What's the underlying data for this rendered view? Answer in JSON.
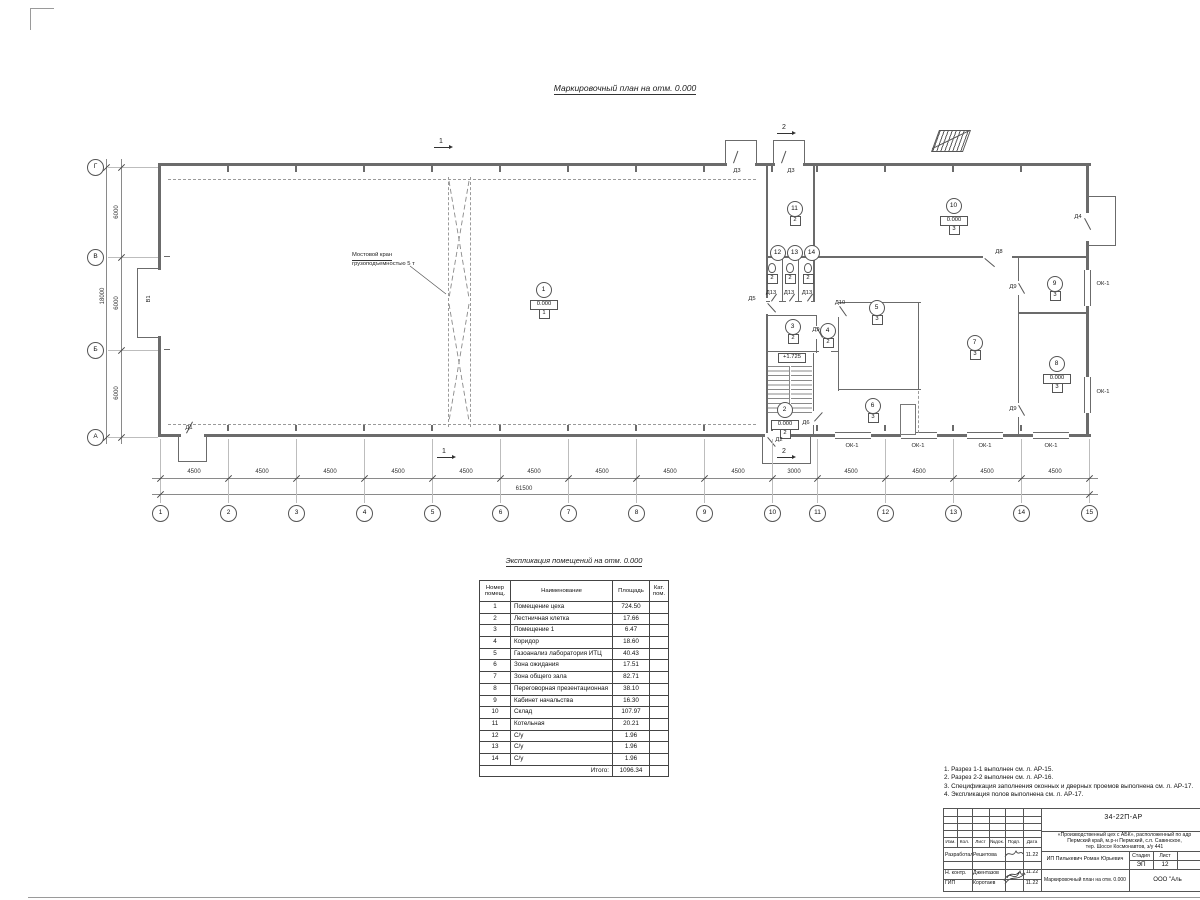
{
  "titles": {
    "plan": "Маркировочный план  на отм. 0.000",
    "table": "Экспликация помещений на отм. 0.000"
  },
  "plan": {
    "crane_line1": "Мостовой кран",
    "crane_line2": "грузоподъемностью 5 т",
    "gate_label": "В1",
    "stair_level": "+1.725",
    "axes_bottom": [
      {
        "n": "1",
        "x": 160
      },
      {
        "n": "2",
        "x": 228
      },
      {
        "n": "3",
        "x": 296
      },
      {
        "n": "4",
        "x": 364
      },
      {
        "n": "5",
        "x": 432
      },
      {
        "n": "6",
        "x": 500
      },
      {
        "n": "7",
        "x": 568
      },
      {
        "n": "8",
        "x": 636
      },
      {
        "n": "9",
        "x": 704
      },
      {
        "n": "10",
        "x": 772
      },
      {
        "n": "11",
        "x": 817
      },
      {
        "n": "12",
        "x": 885
      },
      {
        "n": "13",
        "x": 953
      },
      {
        "n": "14",
        "x": 1021
      },
      {
        "n": "15",
        "x": 1089
      }
    ],
    "axes_left": [
      {
        "n": "Г",
        "y": 167
      },
      {
        "n": "В",
        "y": 257
      },
      {
        "n": "Б",
        "y": 350
      },
      {
        "n": "А",
        "y": 437
      }
    ],
    "dims_bottom": [
      {
        "v": "4500",
        "x": 194
      },
      {
        "v": "4500",
        "x": 262
      },
      {
        "v": "4500",
        "x": 330
      },
      {
        "v": "4500",
        "x": 398
      },
      {
        "v": "4500",
        "x": 466
      },
      {
        "v": "4500",
        "x": 534
      },
      {
        "v": "4500",
        "x": 602
      },
      {
        "v": "4500",
        "x": 670
      },
      {
        "v": "4500",
        "x": 738
      },
      {
        "v": "3000",
        "x": 794
      },
      {
        "v": "4500",
        "x": 851
      },
      {
        "v": "4500",
        "x": 919
      },
      {
        "v": "4500",
        "x": 987
      },
      {
        "v": "4500",
        "x": 1055
      }
    ],
    "dims_left": [
      {
        "v": "6000",
        "y": 212
      },
      {
        "v": "6000",
        "y": 303
      },
      {
        "v": "6000",
        "y": 393
      }
    ],
    "total_bottom": "61500",
    "total_left": "18000",
    "rooms": [
      {
        "n": "1",
        "x": 543,
        "y": 289,
        "level": "0.000",
        "cat": "1"
      },
      {
        "n": "2",
        "x": 784,
        "y": 409,
        "level": "0.000",
        "cat": "2"
      },
      {
        "n": "3",
        "x": 792,
        "y": 326,
        "cat": "2"
      },
      {
        "n": "4",
        "x": 827,
        "y": 330,
        "cat": "2"
      },
      {
        "n": "5",
        "x": 876,
        "y": 307,
        "cat": "3"
      },
      {
        "n": "6",
        "x": 872,
        "y": 405,
        "cat": "3"
      },
      {
        "n": "7",
        "x": 974,
        "y": 342,
        "cat": "3"
      },
      {
        "n": "8",
        "x": 1056,
        "y": 363,
        "level": "0.000",
        "cat": "3"
      },
      {
        "n": "9",
        "x": 1054,
        "y": 283,
        "cat": "3"
      },
      {
        "n": "10",
        "x": 953,
        "y": 205,
        "level": "0.000",
        "cat": "3"
      },
      {
        "n": "11",
        "x": 794,
        "y": 208,
        "cat": "2"
      },
      {
        "n": "12",
        "x": 777,
        "y": 252
      },
      {
        "n": "13",
        "x": 794,
        "y": 252
      },
      {
        "n": "14",
        "x": 811,
        "y": 252
      }
    ],
    "wc_cats": [
      {
        "v": "2",
        "x": 771
      },
      {
        "v": "2",
        "x": 789
      },
      {
        "v": "2",
        "x": 807
      }
    ],
    "labels": [
      {
        "t": "В1",
        "x": 150,
        "y": 299,
        "rot": -90
      },
      {
        "t": "Д1",
        "x": 189,
        "y": 429
      },
      {
        "t": "Д2",
        "x": 779,
        "y": 441
      },
      {
        "t": "Д3",
        "x": 737,
        "y": 172
      },
      {
        "t": "Д3",
        "x": 791,
        "y": 172
      },
      {
        "t": "Д4",
        "x": 1078,
        "y": 218
      },
      {
        "t": "Д5",
        "x": 752,
        "y": 300
      },
      {
        "t": "Д6",
        "x": 806,
        "y": 424
      },
      {
        "t": "Д8",
        "x": 999,
        "y": 253
      },
      {
        "t": "Д9",
        "x": 816,
        "y": 331
      },
      {
        "t": "Д9",
        "x": 1013,
        "y": 288
      },
      {
        "t": "Д9",
        "x": 1013,
        "y": 410
      },
      {
        "t": "Д10",
        "x": 840,
        "y": 304
      },
      {
        "t": "Д13",
        "x": 771,
        "y": 294
      },
      {
        "t": "Д13",
        "x": 789,
        "y": 294
      },
      {
        "t": "Д13",
        "x": 807,
        "y": 294
      },
      {
        "t": "ОК-1",
        "x": 852,
        "y": 447
      },
      {
        "t": "ОК-1",
        "x": 918,
        "y": 447
      },
      {
        "t": "ОК-1",
        "x": 985,
        "y": 447
      },
      {
        "t": "ОК-1",
        "x": 1051,
        "y": 447
      },
      {
        "t": "ОК-1",
        "x": 1103,
        "y": 285
      },
      {
        "t": "ОК-1",
        "x": 1103,
        "y": 393
      }
    ],
    "sections": [
      {
        "t": "1",
        "x": 441,
        "y": 146
      },
      {
        "t": "1",
        "x": 444,
        "y": 456
      },
      {
        "t": "2",
        "x": 784,
        "y": 132
      },
      {
        "t": "2",
        "x": 784,
        "y": 456
      }
    ]
  },
  "table": {
    "headers": [
      "Номер помещ.",
      "Наименование",
      "Площадь",
      "Кат. пом."
    ],
    "rows": [
      {
        "n": "1",
        "name": "Помещение цеха",
        "area": "724.50",
        "cat": ""
      },
      {
        "n": "2",
        "name": "Лестничная клетка",
        "area": "17.66",
        "cat": ""
      },
      {
        "n": "3",
        "name": "Помещение 1",
        "area": "6.47",
        "cat": ""
      },
      {
        "n": "4",
        "name": "Коридор",
        "area": "18.60",
        "cat": ""
      },
      {
        "n": "5",
        "name": "Газоанализ лаборатория ИТЦ",
        "area": "40.43",
        "cat": ""
      },
      {
        "n": "6",
        "name": "Зона ожидания",
        "area": "17.51",
        "cat": ""
      },
      {
        "n": "7",
        "name": "Зона общего зала",
        "area": "82.71",
        "cat": ""
      },
      {
        "n": "8",
        "name": "Переговорная презентационная",
        "area": "38.10",
        "cat": ""
      },
      {
        "n": "9",
        "name": "Кабинет начальства",
        "area": "16.30",
        "cat": ""
      },
      {
        "n": "10",
        "name": "Склад",
        "area": "107.97",
        "cat": ""
      },
      {
        "n": "11",
        "name": "Котельная",
        "area": "20.21",
        "cat": ""
      },
      {
        "n": "12",
        "name": "С/у",
        "area": "1.96",
        "cat": ""
      },
      {
        "n": "13",
        "name": "С/у",
        "area": "1.96",
        "cat": ""
      },
      {
        "n": "14",
        "name": "С/у",
        "area": "1.96",
        "cat": ""
      }
    ],
    "total_label": "Итого:",
    "total": "1096.34"
  },
  "notes": [
    "1. Разрез 1-1 выполнен см. л. АР-15.",
    "2. Разрез 2-2 выполнен см. л. АР-16.",
    "3. Спецификация заполнения оконных и дверных проемов выполнена см. л. АР-17.",
    "4. Экспликация полов выполнена см. л. АР-17."
  ],
  "stamp": {
    "doc_number": "34-22П-АР",
    "project": [
      "«Производственный цех с АБК», расположенный по адр",
      "Пермский край, м.р-н Пермский, с.п. Савинское,",
      "тер. Шоссе Космонавтов, з/у 441"
    ],
    "cols": [
      "Изм.",
      "Кол.",
      "Лист",
      "№док.",
      "Подп.",
      "Дата"
    ],
    "rows": [
      {
        "role": "Разработал",
        "name": "Решетова",
        "date": "11.22"
      },
      {
        "role": "Н. контр.",
        "name": "Джентазов",
        "date": "11.22"
      },
      {
        "role": "ГИП",
        "name": "Коротаев",
        "date": "11.22"
      }
    ],
    "client": "ИП Пилькевич Роман Юрьевич",
    "stage_label": "Стадия",
    "sheet_label": "Лист",
    "stage": "ЭП",
    "sheet": "12",
    "sheet_title": "Маркировочный план на отм. 0.000",
    "org": "ООО \"Аль"
  }
}
